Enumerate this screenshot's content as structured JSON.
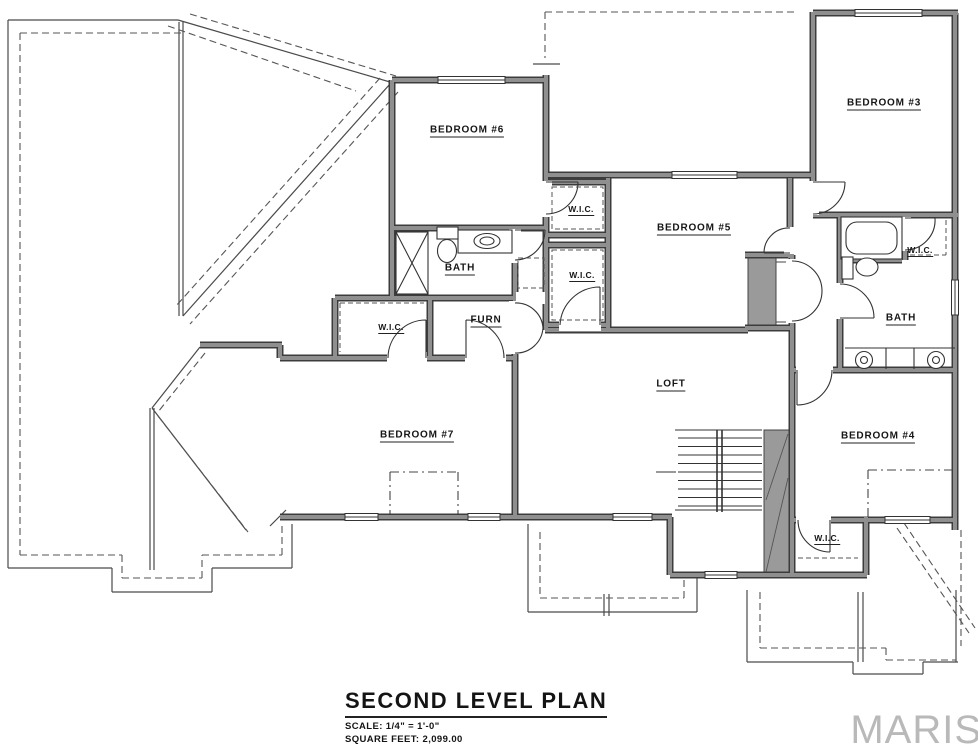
{
  "titleblock": {
    "title": "SECOND LEVEL PLAN",
    "scale": "SCALE: 1/4\" = 1'-0\"",
    "area": "SQUARE FEET: 2,099.00"
  },
  "watermark": {
    "text": "MARIS"
  },
  "rooms": {
    "bedroom6": {
      "label": "BEDROOM #6"
    },
    "bedroom3": {
      "label": "BEDROOM #3"
    },
    "bedroom5": {
      "label": "BEDROOM #5"
    },
    "bedroom7": {
      "label": "BEDROOM #7"
    },
    "bedroom4": {
      "label": "BEDROOM #4"
    },
    "loft": {
      "label": "LOFT"
    },
    "bath_left": {
      "label": "BATH"
    },
    "bath_right": {
      "label": "BATH"
    },
    "furnace": {
      "label": "FURN"
    },
    "wic_hall_upper": {
      "label": "W.I.C."
    },
    "wic_hall_lower": {
      "label": "W.I.C."
    },
    "wic_bedroom7": {
      "label": "W.I.C."
    },
    "wic_bath": {
      "label": "W.I.C."
    },
    "wic_bedroom4": {
      "label": "W.I.C."
    }
  },
  "colors": {
    "wall_edge": "#3c3c3c",
    "wall_core": "#8f8f8f",
    "thin_line": "#333333",
    "roof_line": "#4a4a4a",
    "shaded_fill": "#9a9a9a",
    "watermark": "#b9b9b9"
  }
}
